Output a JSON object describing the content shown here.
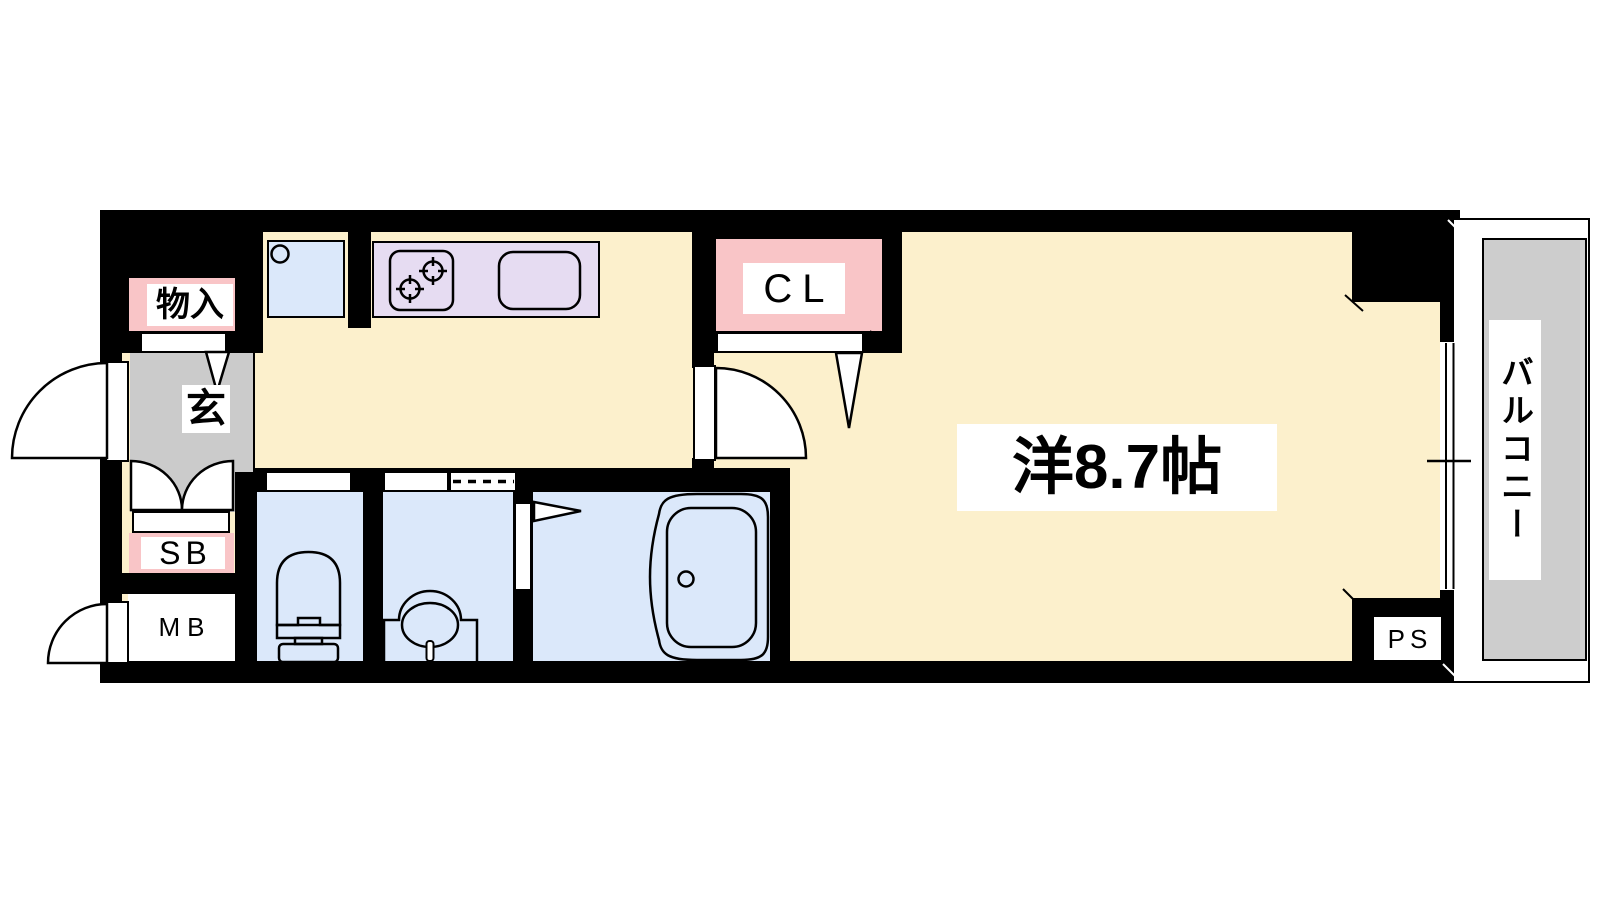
{
  "floorplan": {
    "title": "1K apartment floor plan",
    "labels": {
      "storage": "物入",
      "entrance": "玄",
      "shoe_box": "SB",
      "meter_box": "MB",
      "closet": "CL",
      "western_room": "洋8.7帖",
      "pipe_space": "PS",
      "balcony": "バルコニー"
    },
    "colors": {
      "wall_black": "#000000",
      "floor_cream": "#fcf0cc",
      "wet_blue": "#dbe8fa",
      "kitchen_purple": "#e6dcf2",
      "closet_pink": "#f9c5c7",
      "entrance_gray": "#cbcbcb",
      "balcony_gray": "#cdcdcd",
      "label_bg": "#ffffff"
    },
    "fixtures": [
      "entrance-door",
      "meter-box-door",
      "shoe-box-double-doors",
      "washing-machine-pan",
      "stove-2-burner",
      "kitchen-sink",
      "room-door",
      "closet-folding-door",
      "storage-folding-door",
      "toilet",
      "washbasin",
      "bathtub",
      "bath-folding-door",
      "sliding-door-washroom",
      "balcony-window"
    ]
  }
}
